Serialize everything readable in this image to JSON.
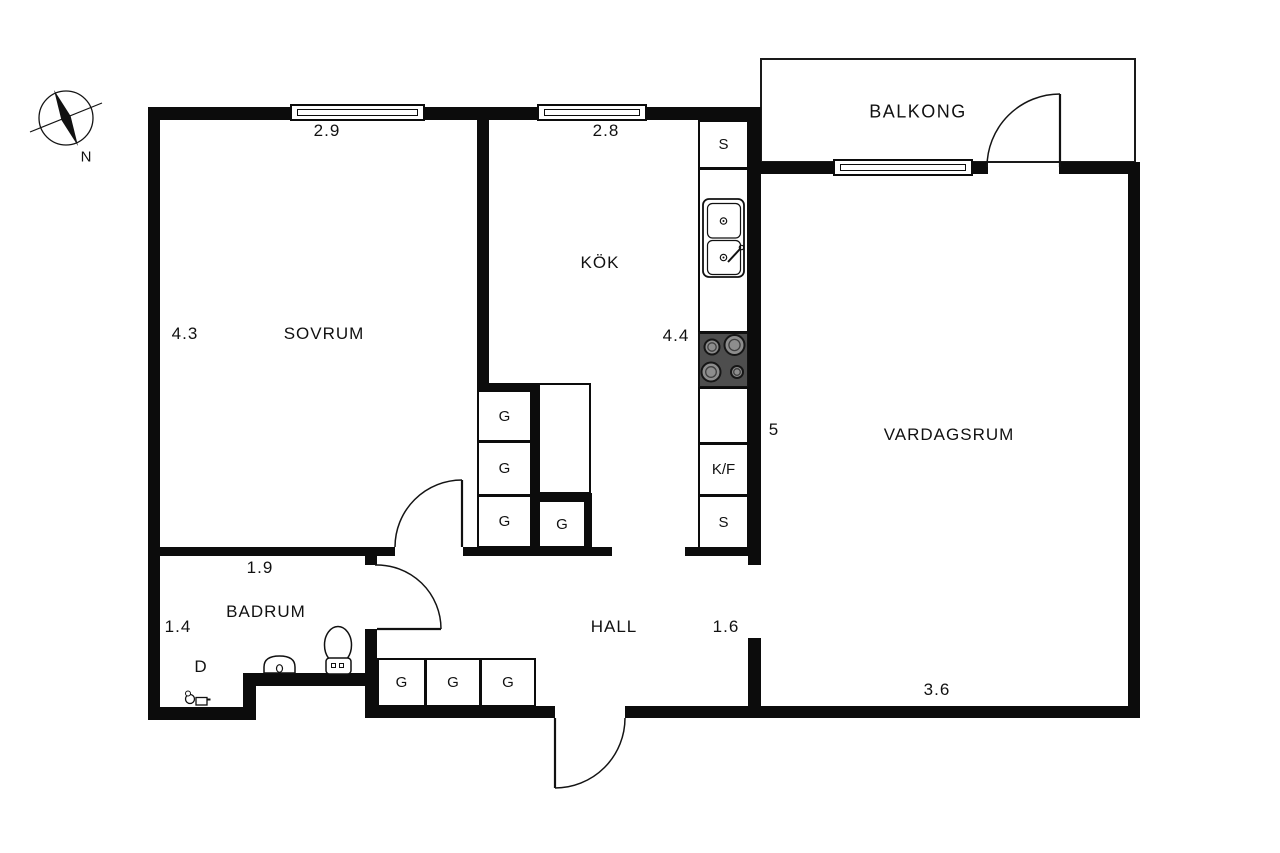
{
  "compass": {
    "north_label": "N"
  },
  "rooms": {
    "balkong": {
      "name": "BALKONG"
    },
    "sovrum": {
      "name": "SOVRUM",
      "dim_top": "2.9",
      "dim_side": "4.3"
    },
    "kok": {
      "name": "KÖK",
      "dim_top": "2.8",
      "dim_side": "4.4"
    },
    "vardagsrum": {
      "name": "VARDAGSRUM",
      "dim_side": "5",
      "dim_bottom": "3.6"
    },
    "badrum": {
      "name": "BADRUM",
      "dim_top": "1.9",
      "dim_side": "1.4",
      "shower_label": "D"
    },
    "hall": {
      "name": "HALL",
      "dim_side": "1.6"
    }
  },
  "fixtures": {
    "wardrobe_label": "G",
    "cabinet_label": "S",
    "fridge_freezer_label": "K/F"
  }
}
